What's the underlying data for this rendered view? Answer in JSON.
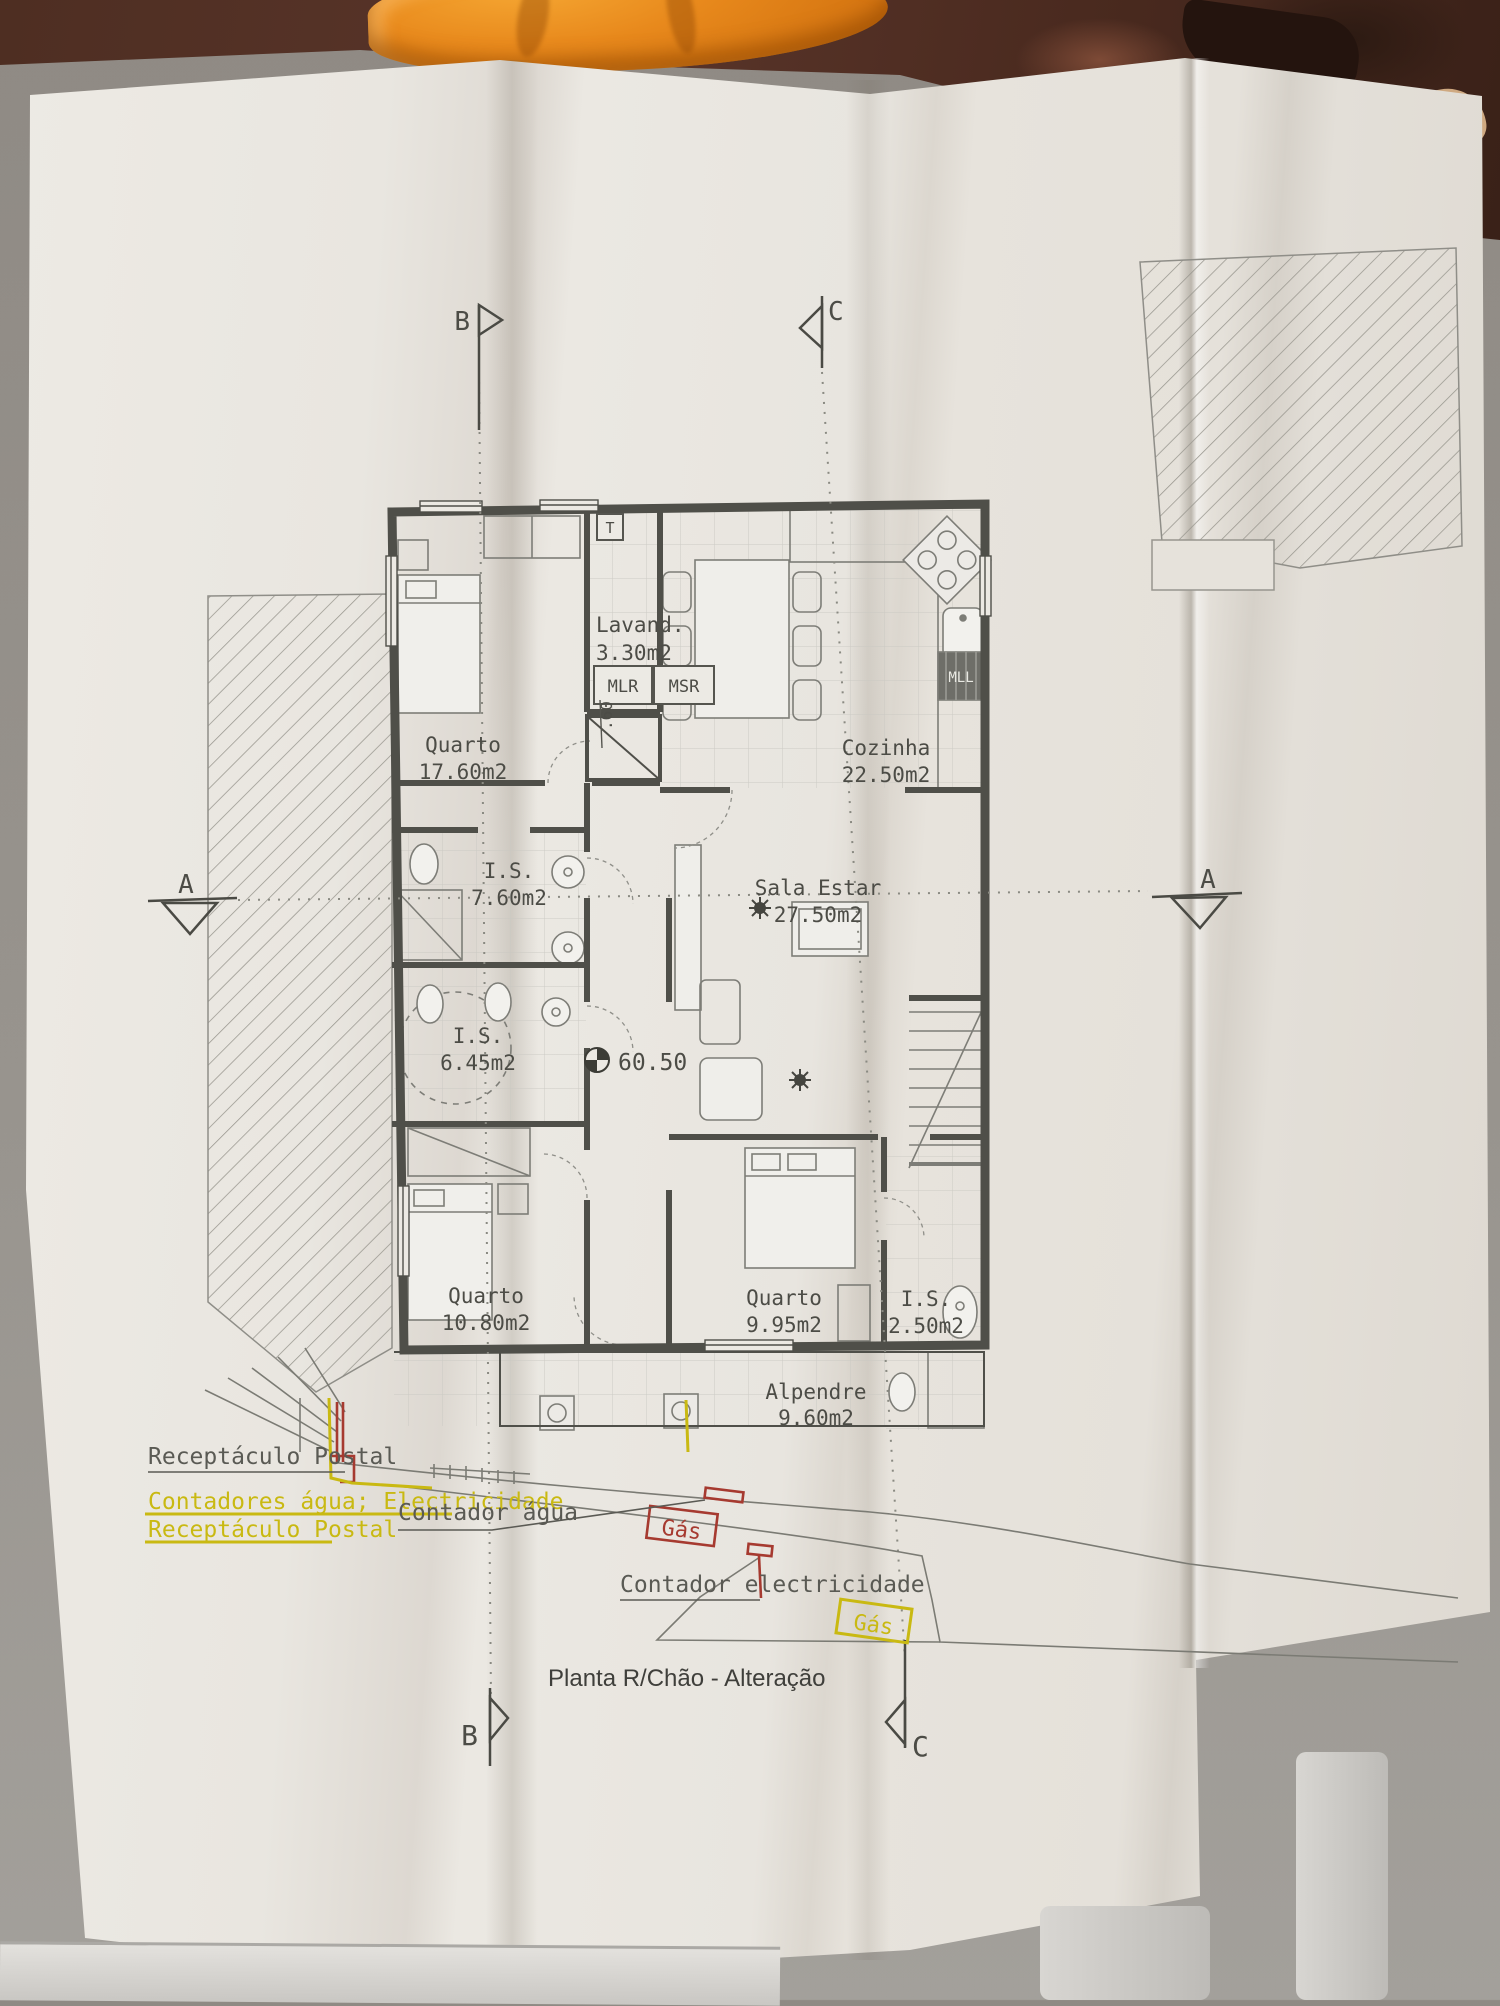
{
  "title": "Planta R/Chão - Alteração",
  "rooms": [
    {
      "name": "Quarto",
      "area": "17.60m2"
    },
    {
      "name": "Lavand.",
      "area": "3.30m2"
    },
    {
      "name": "Cozinha",
      "area": "22.50m2"
    },
    {
      "name": "I.S.",
      "area": "7.60m2"
    },
    {
      "name": "Sala  Estar",
      "area": "27.50m2"
    },
    {
      "name": "I.S.",
      "area": "6.45m2"
    },
    {
      "name": "Quarto",
      "area": "10.80m2"
    },
    {
      "name": "Quarto",
      "area": "9.95m2"
    },
    {
      "name": "I.S.",
      "area": "2.50m2"
    },
    {
      "name": "Alpendre",
      "area": "9.60m2"
    }
  ],
  "labels": {
    "level": "60.50",
    "dim_060": ".60",
    "t_box": "T",
    "mlr": "MLR",
    "msr": "MSR",
    "mll": "MLL"
  },
  "sections": {
    "a": "A",
    "b": "B",
    "c": "C"
  },
  "annotations": {
    "receptaculo_postal_gray": "Receptáculo Postal",
    "contadores": "Contadores água; Electricidade",
    "receptaculo_postal_yellow": "Receptáculo Postal",
    "contador_agua": "Contador água",
    "gas_red": "Gás",
    "contador_electricidade": "Contador electricidade",
    "gas_yellow": "Gás"
  },
  "legend_colors": {
    "ink": "#4c4c46",
    "yellow": "#c9b912",
    "red": "#a63a30",
    "towel": "#e8891c"
  }
}
